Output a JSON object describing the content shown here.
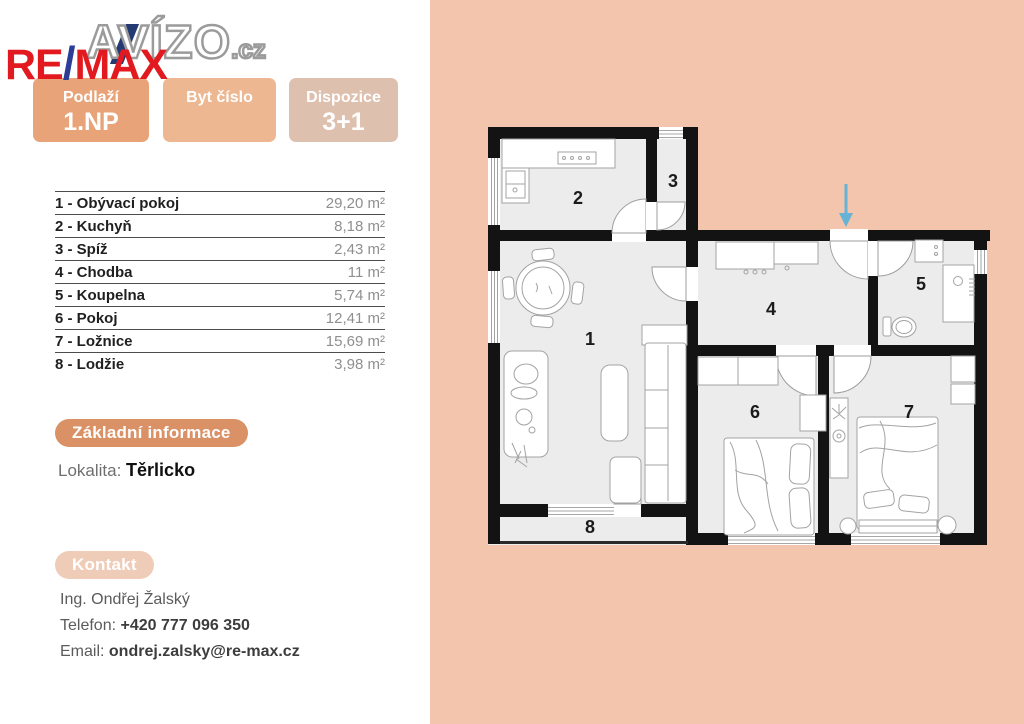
{
  "branding": {
    "avizo": "AVÍZO",
    "avizo_tld": ".cz",
    "remax_re": "RE",
    "remax_slash": "/",
    "remax_max": "MAX"
  },
  "header_boxes": [
    {
      "label": "Podlaží",
      "value": "1.NP"
    },
    {
      "label": "Byt číslo",
      "value": ""
    },
    {
      "label": "Dispozice",
      "value": "3+1"
    }
  ],
  "rooms": [
    {
      "name": "1 - Obývací pokoj",
      "area": "29,20 m²"
    },
    {
      "name": "2 - Kuchyň",
      "area": "8,18 m²"
    },
    {
      "name": "3 - Spíž",
      "area": "2,43 m²"
    },
    {
      "name": "4 - Chodba",
      "area": "11 m²"
    },
    {
      "name": "5 - Koupelna",
      "area": "5,74 m²"
    },
    {
      "name": "6 - Pokoj",
      "area": "12,41 m²"
    },
    {
      "name": "7 - Ložnice",
      "area": "15,69 m²"
    },
    {
      "name": "8 - Lodžie",
      "area": "3,98 m²"
    }
  ],
  "basic_info": {
    "title": "Základní informace",
    "lokalita_label": "Lokalita: ",
    "lokalita_value": "Těrlicko"
  },
  "contact": {
    "title": "Kontakt",
    "name": "Ing. Ondřej Žalský",
    "phone_label": "Telefon: ",
    "phone_value": "+420 777 096 350",
    "email_label": "Email: ",
    "email_value": "ondrej.zalsky@re-max.cz"
  },
  "floorplan": {
    "labels": [
      "1",
      "2",
      "3",
      "4",
      "5",
      "6",
      "7",
      "8"
    ],
    "colors": {
      "panel_background": "#f2c5ac",
      "floor": "#ececec",
      "walls": "#131313",
      "furniture_stroke": "#a3a3a3",
      "entrance_arrow": "#67b3d6"
    }
  }
}
